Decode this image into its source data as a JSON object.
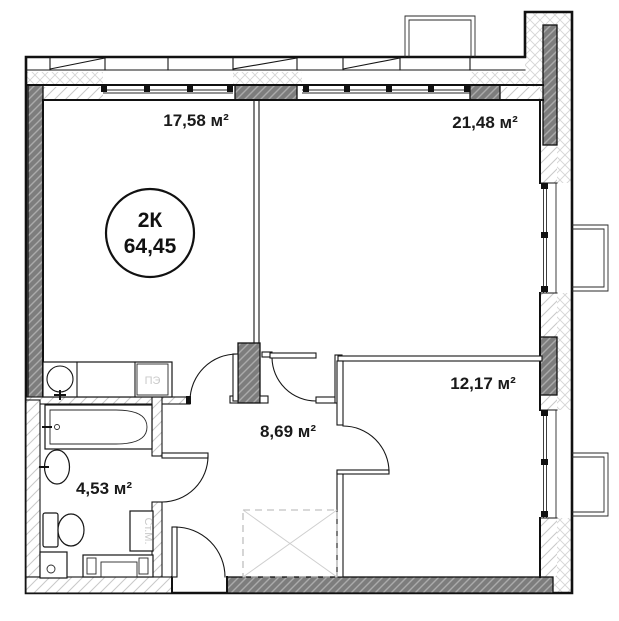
{
  "plan": {
    "unit_badge": {
      "type_label": "2К",
      "total_area": "64,45"
    },
    "rooms": [
      {
        "id": "kitchen",
        "area_label": "17,58 м²"
      },
      {
        "id": "living",
        "area_label": "21,48 м²"
      },
      {
        "id": "bedroom",
        "area_label": "12,17 м²"
      },
      {
        "id": "hallway",
        "area_label": "8,69 м²"
      },
      {
        "id": "bathroom",
        "area_label": "4,53 м²"
      }
    ],
    "fixtures": {
      "stove_label": "ПЭ",
      "washer_label": "Ст.М."
    },
    "colors": {
      "wall_dark": "#7d7d7d",
      "wall_hatch_line": "#ababab",
      "light_hatch_line": "#c8c8c8",
      "cross_hatch_line": "#d4d4d4",
      "outline": "#111111",
      "label_text": "#1a1a1a",
      "fixture_text": "#c9c9c9"
    }
  }
}
